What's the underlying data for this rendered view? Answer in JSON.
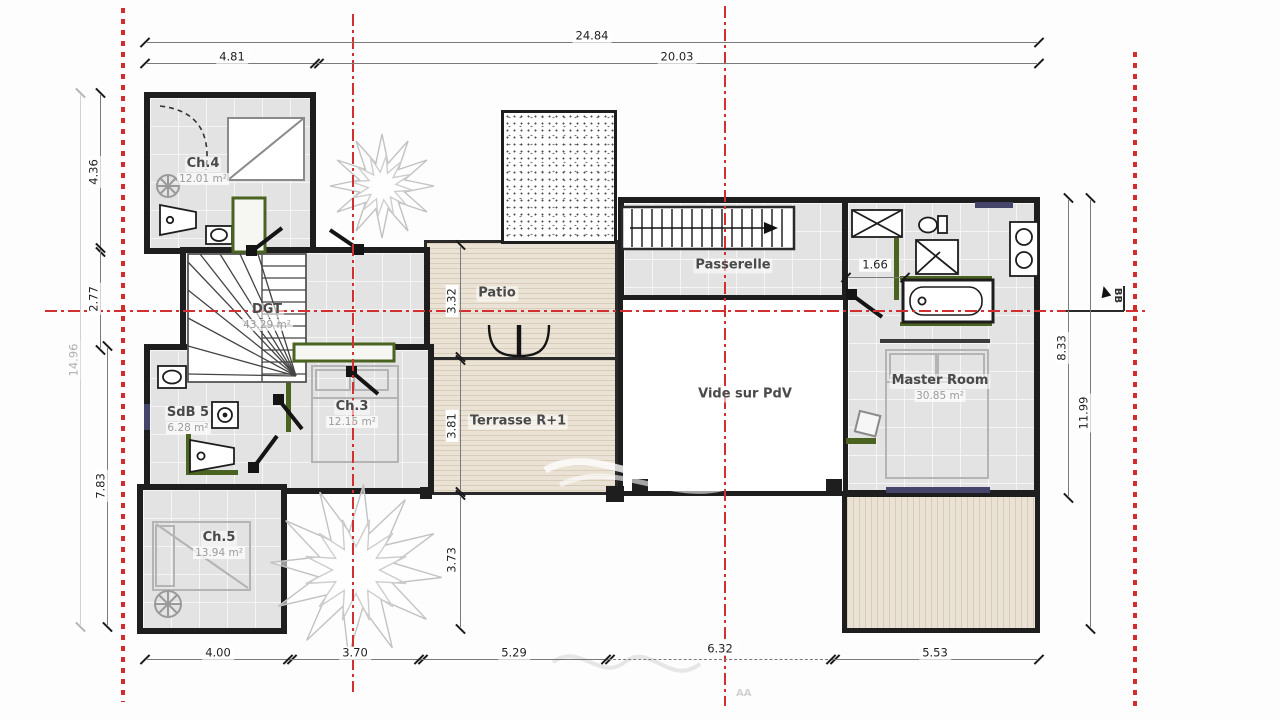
{
  "plan": {
    "title": "Floor plan R+1 (étage)",
    "rooms": [
      {
        "name": "Ch.4",
        "area": "12.01 m²"
      },
      {
        "name": "DGT",
        "area": "43.29 m²"
      },
      {
        "name": "SdB 5",
        "area": "6.28 m²"
      },
      {
        "name": "Ch.3",
        "area": "12.15 m²"
      },
      {
        "name": "Ch.5",
        "area": "13.94 m²"
      },
      {
        "name": "Patio",
        "area": ""
      },
      {
        "name": "Terrasse R+1",
        "area": ""
      },
      {
        "name": "Passerelle",
        "area": ""
      },
      {
        "name": "Vide sur PdV",
        "area": ""
      },
      {
        "name": "Master Room",
        "area": "30.85 m²"
      }
    ],
    "dims": {
      "top_total": "24.84",
      "top_left_wing": "4.81",
      "top_main": "20.03",
      "side_left": [
        "4.36",
        "2.77",
        "7.83"
      ],
      "side_left_total": "14.96",
      "side_right": [
        "8.33",
        "11.99"
      ],
      "bottom": [
        "4.00",
        "3.70",
        "5.29",
        "6.32",
        "5.53"
      ],
      "patio_width": "3.32",
      "terrace_width": "3.81",
      "lower_gap": "3.73",
      "bath_width": "1.66"
    },
    "markers": {
      "section_right": "BB",
      "section_bottom": "AA"
    },
    "colors": {
      "axis_red": "#d23030",
      "floor_gray": "#e2e3e2",
      "deck_beige": "#eae2d4",
      "wall_black": "#1e1e1e",
      "accent_green": "#4a6320",
      "glazing_navy": "#45456b"
    }
  }
}
